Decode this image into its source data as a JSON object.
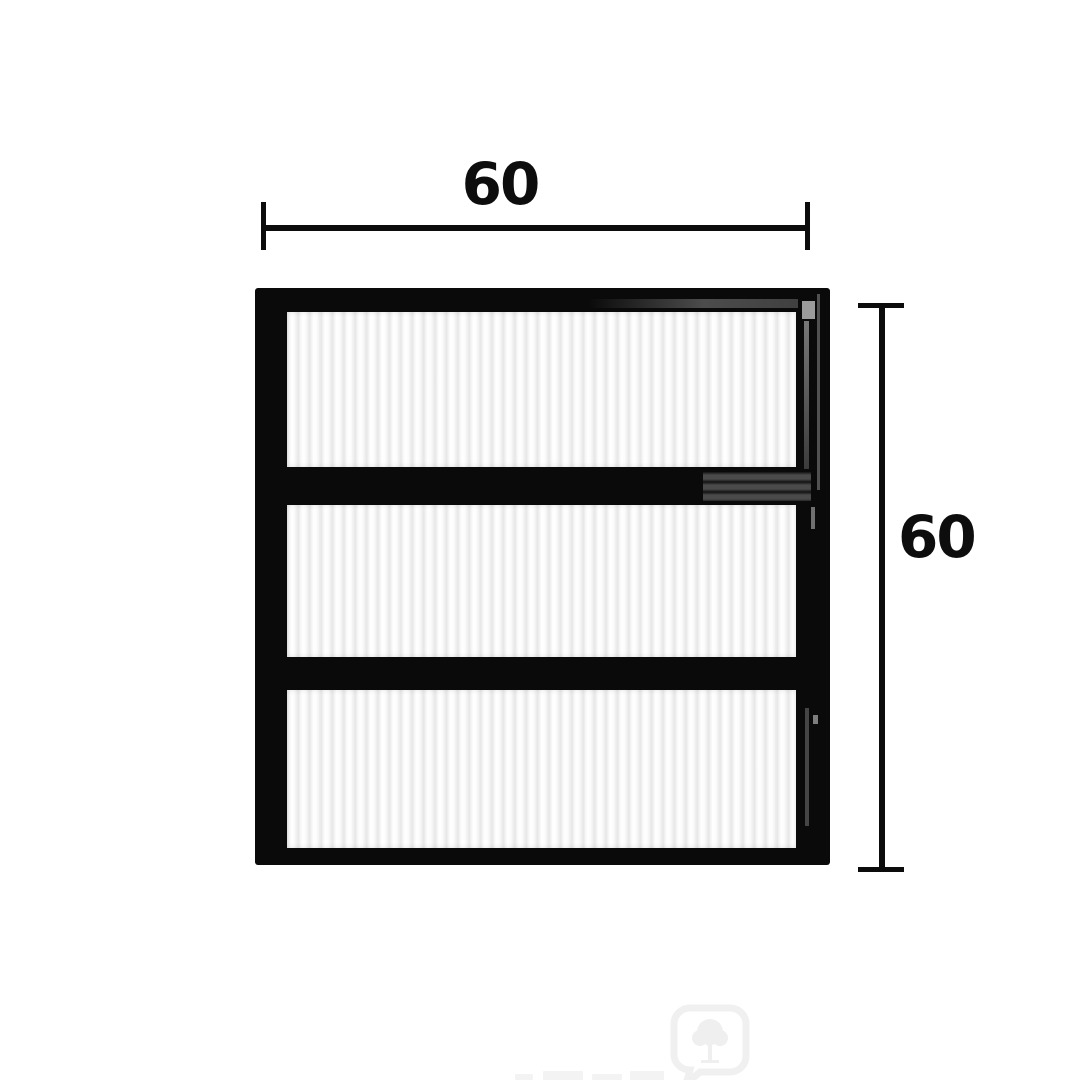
{
  "image": {
    "background_color": "#ffffff",
    "type": "product-dimension-diagram"
  },
  "product": {
    "name": "black-frame-louvre-window",
    "frame_color": "#0a0a0a",
    "glass_style": "corrugated-vertical-rib",
    "glass_color": "#f2f2f2",
    "panel_count": 3
  },
  "dimensions": {
    "width": {
      "value": "60"
    },
    "height": {
      "value": "60"
    }
  },
  "watermark": {
    "logo": "tree-in-rounded-speech-bubble",
    "color": "#f0f0f0"
  }
}
